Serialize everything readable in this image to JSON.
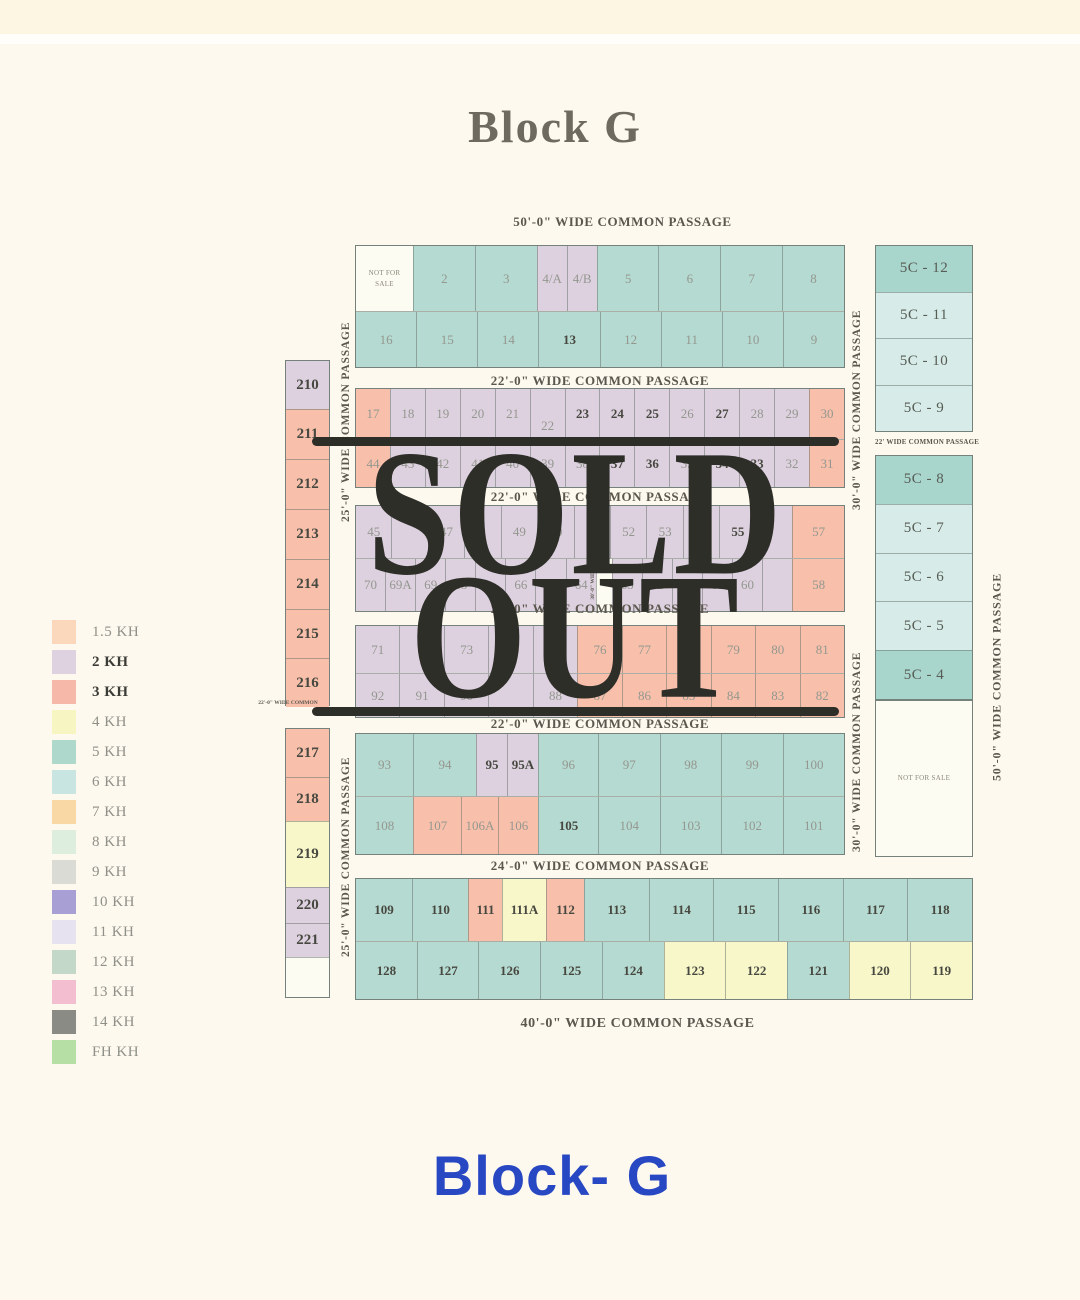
{
  "page": {
    "title": "Block G",
    "footer": "Block- G"
  },
  "overlay": {
    "line1": "SOLD",
    "line2": "OUT"
  },
  "passages": {
    "top": "50'-0\" WIDE COMMON PASSAGE",
    "p1": "22'-0\" WIDE COMMON PASSAGE",
    "p2": "22'-0\" WIDE COMMON PASSAGE",
    "p3": "22'-0\" WIDE COMMON PASSAGE",
    "p4": "22'-0\" WIDE COMMON PASSAGE",
    "p5": "24'-0\" WIDE COMMON PASSAGE",
    "p6": "40'-0\" WIDE COMMON PASSAGE",
    "rc": "22' WIDE COMMON PASSAGE",
    "left_tiny": "22'-0\" WIDE COMMON"
  },
  "vlabels": {
    "v25": "25'-0\" WIDE COMMON PASSAGE",
    "v30": "30'-0\" WIDE COMMON PASSAGE",
    "v50": "50'-0\" WIDE COMMON PASSAGE",
    "mid": "30'-0\" WIDE"
  },
  "legend": {
    "items": [
      {
        "label": "1.5 KH",
        "color": "#fbd8bc",
        "bold": false
      },
      {
        "label": "2 KH",
        "color": "#ded2e0",
        "bold": true
      },
      {
        "label": "3 KH",
        "color": "#f6b8a8",
        "bold": true
      },
      {
        "label": "4 KH",
        "color": "#f7f6c3",
        "bold": false
      },
      {
        "label": "5 KH",
        "color": "#afd8cd",
        "bold": false
      },
      {
        "label": "6 KH",
        "color": "#c8e5e2",
        "bold": false
      },
      {
        "label": "7 KH",
        "color": "#f9d8a5",
        "bold": false
      },
      {
        "label": "8 KH",
        "color": "#ddeede",
        "bold": false
      },
      {
        "label": "9 KH",
        "color": "#dbdbd5",
        "bold": false
      },
      {
        "label": "10 KH",
        "color": "#a8a0d4",
        "bold": false
      },
      {
        "label": "11 KH",
        "color": "#e6e2ef",
        "bold": false
      },
      {
        "label": "12 KH",
        "color": "#c3d8c9",
        "bold": false
      },
      {
        "label": "13 KH",
        "color": "#f3bfd0",
        "bold": false
      },
      {
        "label": "14 KH",
        "color": "#8b8b85",
        "bold": false
      },
      {
        "label": "FH KH",
        "color": "#b5dfa5",
        "bold": false
      }
    ]
  },
  "map": {
    "r1": [
      {
        "t": "NOT FOR SALE",
        "c": "white",
        "s": "tiny",
        "w": 57
      },
      {
        "t": "2",
        "c": "teal"
      },
      {
        "t": "3",
        "c": "teal"
      },
      {
        "t": "4/A",
        "c": "lav",
        "w": 30
      },
      {
        "t": "4/B",
        "c": "lav",
        "w": 30
      },
      {
        "t": "5",
        "c": "teal"
      },
      {
        "t": "6",
        "c": "teal"
      },
      {
        "t": "7",
        "c": "teal"
      },
      {
        "t": "8",
        "c": "teal"
      }
    ],
    "r2": [
      {
        "t": "16",
        "c": "teal"
      },
      {
        "t": "15",
        "c": "teal"
      },
      {
        "t": "14",
        "c": "teal"
      },
      {
        "t": "13",
        "c": "teal",
        "b": true
      },
      {
        "t": "12",
        "c": "teal"
      },
      {
        "t": "11",
        "c": "teal"
      },
      {
        "t": "10",
        "c": "teal"
      },
      {
        "t": "9",
        "c": "teal"
      }
    ],
    "r3": [
      {
        "t": "17",
        "c": "salmon"
      },
      {
        "t": "18",
        "c": "lav"
      },
      {
        "t": "19",
        "c": "lav"
      },
      {
        "t": "20",
        "c": "lav"
      },
      {
        "t": "21",
        "c": "lav"
      },
      {
        "t": "22",
        "c": "lav",
        "s": "low"
      },
      {
        "t": "23",
        "c": "lav",
        "b": true
      },
      {
        "t": "24",
        "c": "lav",
        "b": true
      },
      {
        "t": "25",
        "c": "lav",
        "b": true
      },
      {
        "t": "26",
        "c": "lav"
      },
      {
        "t": "27",
        "c": "lav",
        "b": true
      },
      {
        "t": "28",
        "c": "lav"
      },
      {
        "t": "29",
        "c": "lav"
      },
      {
        "t": "30",
        "c": "salmon"
      }
    ],
    "r4": [
      {
        "t": "44",
        "c": "salmon"
      },
      {
        "t": "43",
        "c": "lav"
      },
      {
        "t": "42",
        "c": "lav"
      },
      {
        "t": "41",
        "c": "lav"
      },
      {
        "t": "40",
        "c": "lav"
      },
      {
        "t": "39",
        "c": "lav"
      },
      {
        "t": "38",
        "c": "lav"
      },
      {
        "t": "37",
        "c": "lav",
        "b": true
      },
      {
        "t": "36",
        "c": "lav",
        "b": true
      },
      {
        "t": "35",
        "c": "lav"
      },
      {
        "t": "34",
        "c": "lav",
        "b": true
      },
      {
        "t": "33",
        "c": "lav",
        "b": true
      },
      {
        "t": "32",
        "c": "lav"
      },
      {
        "t": "31",
        "c": "salmon"
      }
    ],
    "r5": [
      {
        "t": "45",
        "c": "lav"
      },
      {
        "t": "",
        "c": "lav"
      },
      {
        "t": "47",
        "c": "lav"
      },
      {
        "t": "",
        "c": "lav"
      },
      {
        "t": "49",
        "c": "lav"
      },
      {
        "t": "50",
        "c": "lav"
      },
      {
        "t": "51",
        "c": "lav"
      },
      {
        "t": "52",
        "c": "lav"
      },
      {
        "t": "53",
        "c": "lav"
      },
      {
        "t": "",
        "c": "lav"
      },
      {
        "t": "55",
        "c": "lav",
        "b": true
      },
      {
        "t": "",
        "c": "lav"
      },
      {
        "t": "57",
        "c": "salmon",
        "w": 52
      }
    ],
    "r6": [
      {
        "t": "70",
        "c": "lav"
      },
      {
        "t": "69A",
        "c": "lav"
      },
      {
        "t": "69",
        "c": "lav"
      },
      {
        "t": "68",
        "c": "lav"
      },
      {
        "t": "",
        "c": "lav"
      },
      {
        "t": "66",
        "c": "lav"
      },
      {
        "t": "",
        "c": "lav"
      },
      {
        "t": "64",
        "c": "lav"
      },
      {
        "t": "",
        "c": "white",
        "w": 16
      },
      {
        "t": "63",
        "c": "lav"
      },
      {
        "t": "62",
        "c": "lav"
      },
      {
        "t": "61A",
        "c": "lav",
        "b": true
      },
      {
        "t": "61",
        "c": "lav"
      },
      {
        "t": "60",
        "c": "lav"
      },
      {
        "t": "",
        "c": "lav"
      },
      {
        "t": "58",
        "c": "salmon",
        "w": 52
      }
    ],
    "r7": [
      {
        "t": "71",
        "c": "lav"
      },
      {
        "t": "",
        "c": "lav"
      },
      {
        "t": "73",
        "c": "lav"
      },
      {
        "t": "",
        "c": "lav"
      },
      {
        "t": "75",
        "c": "lav"
      },
      {
        "t": "76",
        "c": "salmon"
      },
      {
        "t": "77",
        "c": "salmon"
      },
      {
        "t": "78",
        "c": "salmon"
      },
      {
        "t": "79",
        "c": "salmon"
      },
      {
        "t": "80",
        "c": "salmon"
      },
      {
        "t": "81",
        "c": "salmon"
      }
    ],
    "r8": [
      {
        "t": "92",
        "c": "lav"
      },
      {
        "t": "91",
        "c": "lav"
      },
      {
        "t": "90",
        "c": "lav"
      },
      {
        "t": "",
        "c": "lav"
      },
      {
        "t": "88",
        "c": "lav"
      },
      {
        "t": "87",
        "c": "salmon"
      },
      {
        "t": "86",
        "c": "salmon"
      },
      {
        "t": "85",
        "c": "salmon"
      },
      {
        "t": "84",
        "c": "salmon"
      },
      {
        "t": "83",
        "c": "salmon"
      },
      {
        "t": "82",
        "c": "salmon"
      }
    ],
    "r9": [
      {
        "t": "93",
        "c": "teal",
        "w": 57
      },
      {
        "t": "94",
        "c": "teal",
        "w": 63
      },
      {
        "t": "95",
        "c": "lav",
        "b": true,
        "w": 31
      },
      {
        "t": "95A",
        "c": "lav",
        "b": true,
        "w": 31
      },
      {
        "t": "96",
        "c": "teal",
        "w": 60
      },
      {
        "t": "97",
        "c": "teal"
      },
      {
        "t": "98",
        "c": "teal"
      },
      {
        "t": "99",
        "c": "teal"
      },
      {
        "t": "100",
        "c": "teal"
      }
    ],
    "r10": [
      {
        "t": "108",
        "c": "teal",
        "w": 57
      },
      {
        "t": "107",
        "c": "salmon",
        "w": 48
      },
      {
        "t": "106A",
        "c": "salmon",
        "w": 37
      },
      {
        "t": "106",
        "c": "salmon",
        "w": 40
      },
      {
        "t": "105",
        "c": "teal",
        "b": true,
        "w": 60
      },
      {
        "t": "104",
        "c": "teal"
      },
      {
        "t": "103",
        "c": "teal"
      },
      {
        "t": "102",
        "c": "teal"
      },
      {
        "t": "101",
        "c": "teal"
      }
    ],
    "r11": [
      {
        "t": "109",
        "c": "teal",
        "b": true,
        "w": 56
      },
      {
        "t": "110",
        "c": "teal",
        "b": true,
        "w": 56
      },
      {
        "t": "111",
        "c": "salmon",
        "b": true,
        "w": 34
      },
      {
        "t": "111A",
        "c": "yellow",
        "b": true,
        "w": 44
      },
      {
        "t": "112",
        "c": "salmon",
        "b": true,
        "w": 38
      },
      {
        "t": "113",
        "c": "teal",
        "b": true
      },
      {
        "t": "114",
        "c": "teal",
        "b": true
      },
      {
        "t": "115",
        "c": "teal",
        "b": true
      },
      {
        "t": "116",
        "c": "teal",
        "b": true
      },
      {
        "t": "117",
        "c": "teal",
        "b": true
      },
      {
        "t": "118",
        "c": "teal",
        "b": true
      }
    ],
    "r12": [
      {
        "t": "128",
        "c": "teal",
        "b": true
      },
      {
        "t": "127",
        "c": "teal",
        "b": true
      },
      {
        "t": "126",
        "c": "teal",
        "b": true
      },
      {
        "t": "125",
        "c": "teal",
        "b": true
      },
      {
        "t": "124",
        "c": "teal",
        "b": true
      },
      {
        "t": "123",
        "c": "yellow",
        "b": true
      },
      {
        "t": "122",
        "c": "yellow",
        "b": true
      },
      {
        "t": "121",
        "c": "teal",
        "b": true
      },
      {
        "t": "120",
        "c": "yellow",
        "b": true
      },
      {
        "t": "119",
        "c": "yellow",
        "b": true
      }
    ],
    "lc1": [
      {
        "t": "210",
        "c": "lav",
        "b": true,
        "w": 48
      },
      {
        "t": "211",
        "c": "salmon",
        "b": true,
        "w": 50
      },
      {
        "t": "212",
        "c": "salmon",
        "b": true,
        "w": 50
      },
      {
        "t": "213",
        "c": "salmon",
        "b": true,
        "w": 50
      },
      {
        "t": "214",
        "c": "salmon",
        "b": true,
        "w": 50
      },
      {
        "t": "215",
        "c": "salmon",
        "b": true,
        "w": 49
      },
      {
        "t": "216",
        "c": "salmon",
        "b": true,
        "w": 49
      }
    ],
    "lc2": [
      {
        "t": "217",
        "c": "salmon",
        "b": true,
        "w": 48
      },
      {
        "t": "218",
        "c": "salmon",
        "b": true,
        "w": 44
      },
      {
        "t": "219",
        "c": "yellow",
        "b": true,
        "w": 66
      },
      {
        "t": "220",
        "c": "lav",
        "b": true,
        "w": 36
      },
      {
        "t": "221",
        "c": "lav",
        "b": true,
        "w": 34
      },
      {
        "t": "",
        "c": "white"
      }
    ],
    "rc1": [
      {
        "t": "5C - 12",
        "c": "tealdark"
      },
      {
        "t": "5C - 11",
        "c": "blue"
      },
      {
        "t": "5C - 10",
        "c": "blue"
      },
      {
        "t": "5C - 9",
        "c": "blue"
      }
    ],
    "rc2": [
      {
        "t": "5C - 8",
        "c": "tealdark"
      },
      {
        "t": "5C - 7",
        "c": "blue"
      },
      {
        "t": "5C - 6",
        "c": "blue"
      },
      {
        "t": "5C - 5",
        "c": "blue"
      },
      {
        "t": "5C - 4",
        "c": "tealdark"
      }
    ],
    "rc3": [
      {
        "t": "NOT FOR SALE",
        "c": "white",
        "s": "tiny"
      }
    ]
  }
}
